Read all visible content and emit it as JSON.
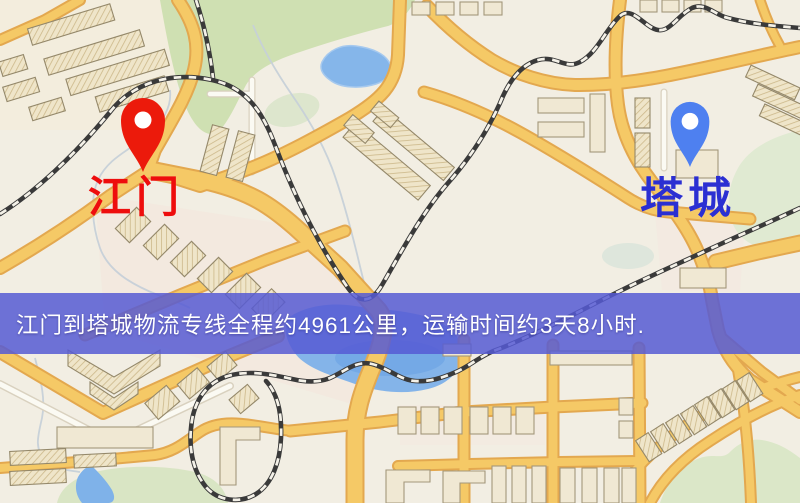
{
  "map": {
    "origin_label": "江门",
    "destination_label": "塔城",
    "origin_label_color": "#ee0d0d",
    "destination_label_color": "#2b2fd2",
    "origin_pin_color": "#ec1a0b",
    "destination_pin_color": "#4e80f0",
    "feature_colors": {
      "background": "#f2eee3",
      "major_road": "#f5c966",
      "road_casing": "#e3a84f",
      "park_green": "#cfe0b2",
      "water_blue": "#84b4e9",
      "railway_dark": "#3a3a3a",
      "building_beige": "#f0e8d3"
    }
  },
  "banner": {
    "text": "江门到塔城物流专线全程约4961公里，运输时间约3天8小时.",
    "background_rgba": "rgba(86,90,212,0.85)",
    "text_color": "#ffffff"
  },
  "pins": {
    "origin_icon": "red-location-pin",
    "destination_icon": "blue-location-pin"
  }
}
